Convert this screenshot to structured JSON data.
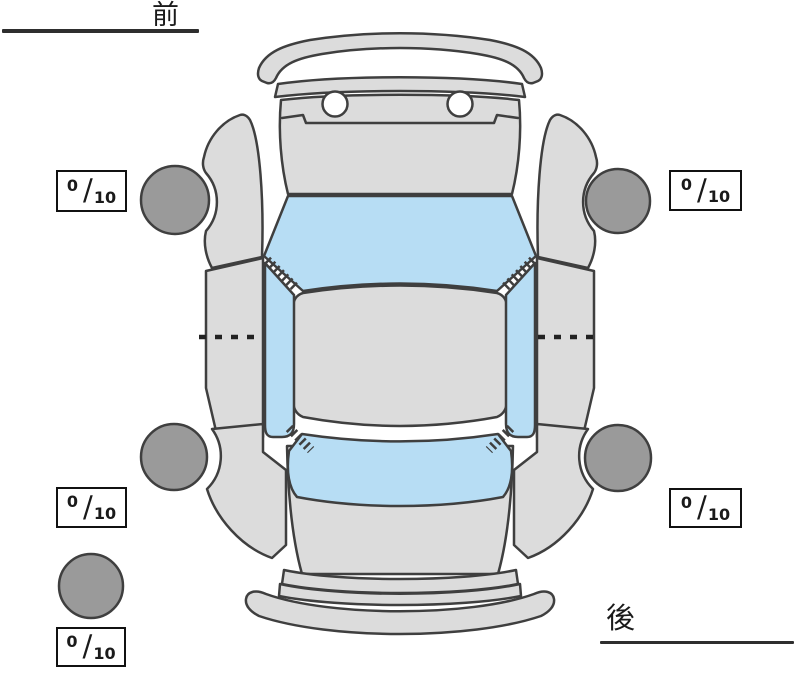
{
  "orientation": {
    "front_label": "前",
    "rear_label": "後"
  },
  "tread": {
    "separator": "/",
    "front_left": {
      "value": "0",
      "max": "10"
    },
    "front_right": {
      "value": "0",
      "max": "10"
    },
    "rear_left": {
      "value": "0",
      "max": "10"
    },
    "rear_right": {
      "value": "0",
      "max": "10"
    },
    "spare": {
      "value": "0",
      "max": "10"
    }
  },
  "diagram": {
    "kind": "car-top-view-tire-condition",
    "tires": [
      "front-left",
      "front-right",
      "rear-left",
      "rear-right",
      "spare"
    ]
  },
  "colors": {
    "background": "#ffffff",
    "body_fill": "#dcdcdc",
    "glass_fill": "#b7ddf4",
    "tire_fill": "#9a9a9a",
    "outline": "#3f3f3f",
    "label_text": "#1a1a1a",
    "box_border": "#111111",
    "box_fill": "#ffffff"
  }
}
